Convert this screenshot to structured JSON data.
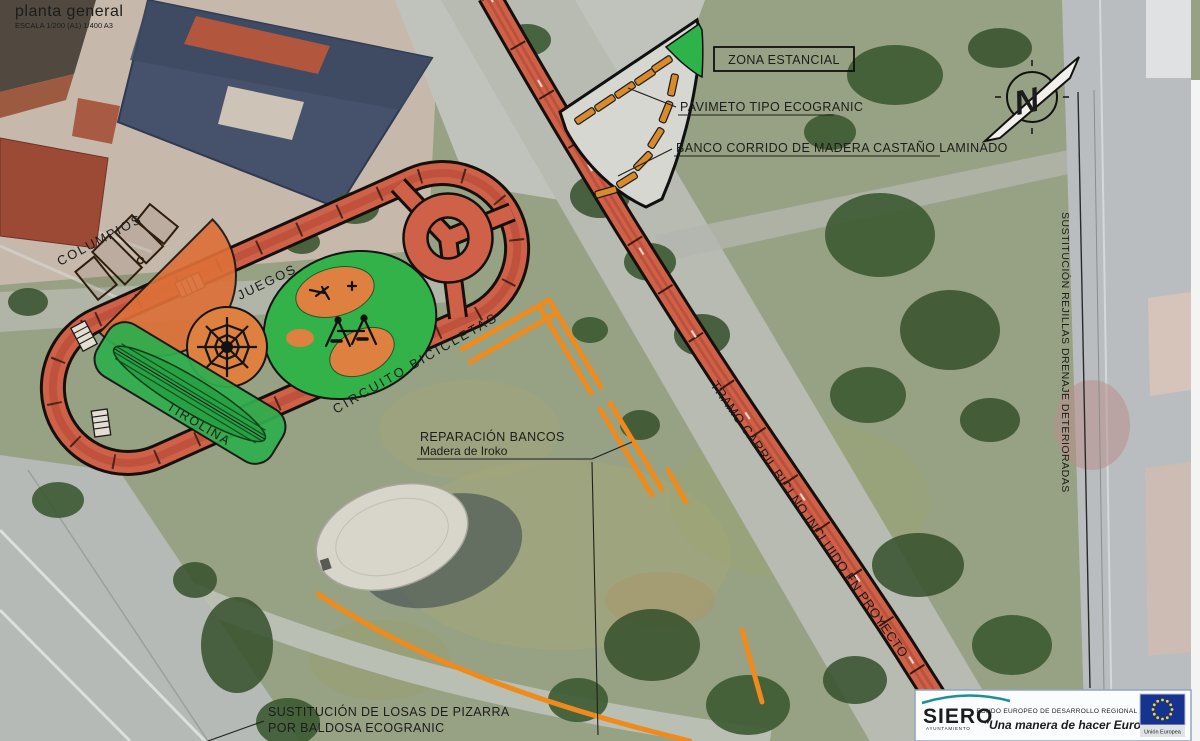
{
  "title_block": {
    "title": "planta general",
    "scale": "ESCALA 1/200 (A1) 1/400 A3"
  },
  "plan_labels": {
    "zona_estancial": "ZONA ESTANCIAL",
    "pavimento": "PAVIMETO TIPO ECOGRANIC",
    "banco_corrido": "BANCO CORRIDO DE MADERA CASTAÑO LAMINADO",
    "columpios": "COLUMPIOS",
    "juegos": "JUEGOS",
    "tirolina": "TIROLINA",
    "circuito_bicicletas": "CIRCUITO BICICLETAS",
    "reparacion_bancos_1": "REPARACIÓN BANCOS",
    "reparacion_bancos_2": "Madera de Iroko",
    "tramo_carril": "TRAMO CARRIL BICI NO INCLUIDO EN PROYECTO",
    "rejillas": "SUSTITUCIÓN REJILLAS DRENAJE DETERIORADAS",
    "losas_1": "SUSTITUCIÓN DE LOSAS DE PIZARRA",
    "losas_2": "POR BALDOSA ECOGRANIC",
    "north_letter": "N"
  },
  "footer": {
    "siero_logo": "SIERO",
    "siero_sub": "AYUNTAMIENTO",
    "feder_line": "FONDO EUROPEO DE DESARROLLO REGIONAL (FEDER)",
    "motto": "\"Una manera de hacer Europa\"",
    "eu_label": "Unión Europea"
  },
  "colors": {
    "track_red": "#cf6149",
    "track_edge": "#15100c",
    "marking_orange": "#ef8a1c",
    "bench_orange": "#d98a2b",
    "play_green": "#33b24a",
    "area_orange": "#dd7038",
    "navy": "#1d3c6e",
    "teal": "#169a9c",
    "eu_blue": "#16338f",
    "eu_star_yellow": "#ffd617"
  }
}
